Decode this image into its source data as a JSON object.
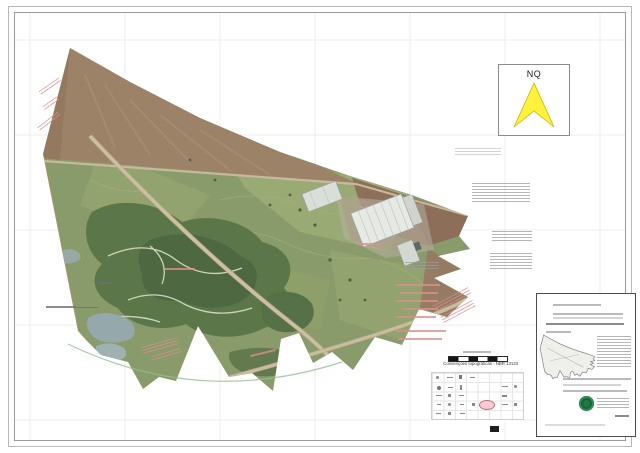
{
  "north_indicator": {
    "label": "NQ"
  },
  "legend": {
    "title": "Convenções topográficas - NBR 13133"
  },
  "colors": {
    "north_arrow_yellow": "#fff23c",
    "legend_highlight_pink": "#f5ccd4",
    "stamp_green": "#1e7a3e",
    "field_green": "#8a9b6b",
    "forest_green": "#5b7749",
    "bare_soil_brown": "#9c8367",
    "road_tan": "#ccbfa2",
    "water_gray_blue": "#95a8ab"
  }
}
